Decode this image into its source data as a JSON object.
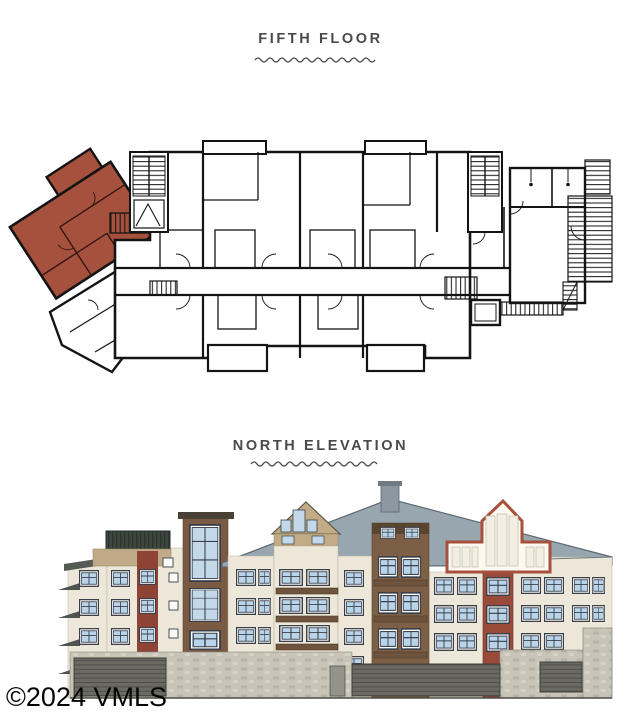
{
  "sections": {
    "floorplan": {
      "title": "FIFTH FLOOR"
    },
    "elevation": {
      "title": "NORTH ELEVATION"
    }
  },
  "watermark": {
    "text": "©2024 VMLS"
  },
  "colors": {
    "title_text": "#4c4a49",
    "plan_walls": "#141414",
    "highlight_unit": "#a5513e",
    "roof_gray": "#97a6af",
    "wall_cream": "#ece7d8",
    "wall_tan": "#c0aa87",
    "brick_red": "#9a4a38",
    "maroon_strip": "#8e4335",
    "brown_siding": "#7d5f45",
    "window_glass": "#b9d3e8",
    "stone_base": "#c8c4b8",
    "deck_railing_green": "#3d463f"
  }
}
